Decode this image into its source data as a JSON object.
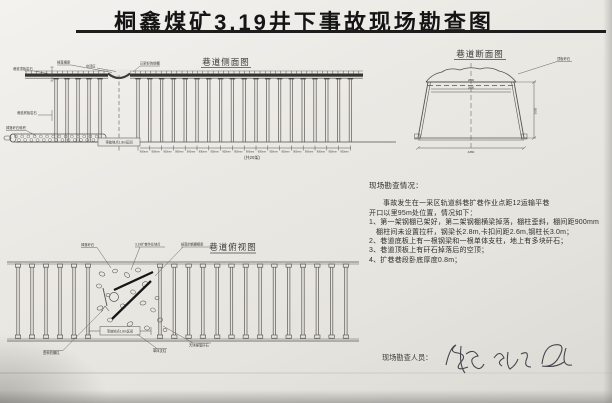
{
  "title": "桐鑫煤矿3.19井下事故现场勘查图",
  "side_view": {
    "label": "巷道侧面图",
    "callout_roof_rock": "巷道顶板岩石",
    "callout_fallen_beam": "掉落横梁",
    "callout_cavity": "空顶区",
    "callout_shed": "已架好的钢棚",
    "callout_floor_rock": "巷道底板岩石",
    "callout_debris": "掉落矸石堆积",
    "accident_span_label": "事故地点1.8m区间",
    "bay_label": "900mm",
    "total_label": "(共20架)"
  },
  "cross_section": {
    "label": "巷道断面图",
    "callout_roof_rock": "顶板矸石",
    "dim_beam": "2800",
    "dim_clamp": "2600",
    "dim_height": "3000",
    "dim_bottom": "4200"
  },
  "plan_view": {
    "label": "巷道俯视图",
    "callout_fallen_rock": "掉落矸石",
    "callout_worksite": "3.19扩巷作业地点",
    "callout_fallen_beam": "掉落的钢棚横梁",
    "callout_tilted_post": "歪斜的棚柱",
    "callout_prop": "单体支柱",
    "callout_debris": "大块掉落矸石",
    "accident_span_label": "事故地点1.8m区间"
  },
  "notes": {
    "heading": "现场勘查情况：",
    "lines": [
      "事故发生在一采区轨道斜巷扩巷作业点距12运输平巷",
      "开口以里95m处位置，情况如下：",
      "1、第一架钢棚已架好，第二架钢棚横梁掉落，棚柱歪斜，棚间距900mm",
      "棚柱间未设置拉杆，钢梁长2.8m,卡扣间距2.6m,钢柱长3.0m；",
      "2、巷道底板上有一根钢梁和一根单体支柱，地上有多块矸石；",
      "3、巷道顶板上有矸石掉落后的空顶；",
      "4、扩巷巷段卧底厚度0.8m；"
    ]
  },
  "footer": {
    "surveyors_label": "现场勘查人员："
  },
  "colors": {
    "paper": "#e9e7e2",
    "ink": "#1d1d1d",
    "line": "#55534f"
  }
}
